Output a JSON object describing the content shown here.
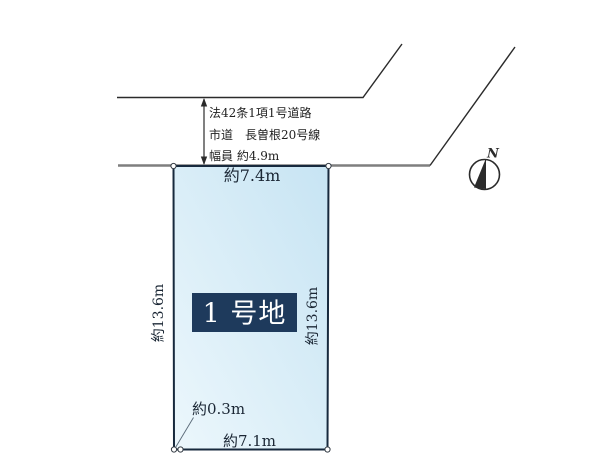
{
  "diagram": {
    "road_info": {
      "line1": "法42条1項1号道路",
      "line2": "市道　長曽根20号線",
      "line3": "幅員 約4.9m"
    },
    "plot": {
      "label": "1 号地",
      "top_width": "約7.4m",
      "left_depth": "約13.6m",
      "right_depth": "約13.6m",
      "bottom_width": "約7.1m",
      "corner_offset": "約0.3m"
    },
    "compass": {
      "north": "N"
    }
  },
  "colors": {
    "plot_fill_light": "#ecf7fc",
    "plot_fill_dark": "#c7e4f3",
    "plot_border": "#17293d",
    "label_bg": "#1e3a5c",
    "label_text": "#ffffff",
    "road_gray": "#7f7f7f",
    "line_black": "#2b2b2b",
    "dim_text": "#1b2735",
    "road_text": "#1f1f1f",
    "leader_line": "#5a6a78",
    "vertex_stroke": "#333b44"
  }
}
